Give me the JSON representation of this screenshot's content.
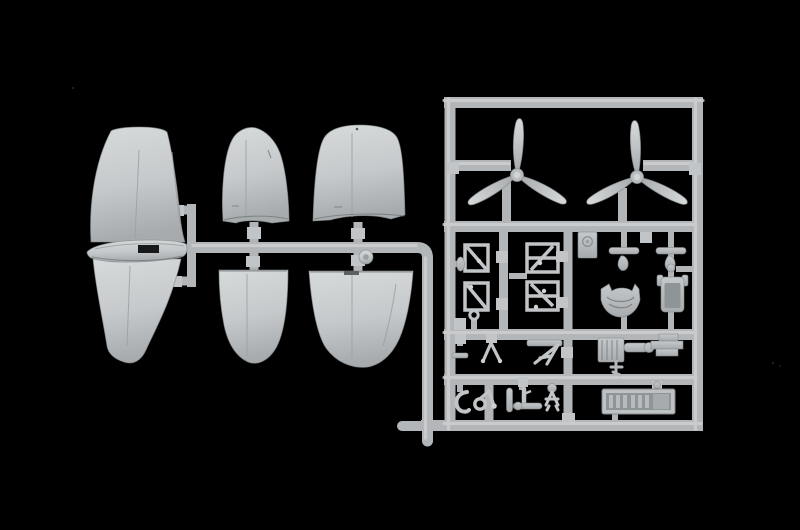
{
  "meta": {
    "description": "Photograph of a light-grey injection-moulded plastic model aircraft sprue on a black background",
    "alt": "Model kit sprue: large wing and tailplane halves on the left joined by a runner, and a rectangular frame on the right holding two three-blade propellers, strut frames, instrument panel, seat, bulkhead, engine block, cockpit floor tray and other small parts"
  },
  "colors": {
    "background": "#000000",
    "plastic_light": "#d7dadb",
    "plastic": "#c6c9cb",
    "plastic_dark": "#a7abad",
    "runner": "#b2b6b8",
    "runner_highlight": "#ced1d2",
    "tab": "#c1c5c7",
    "slot": "#17191a",
    "recess": "#8f9496"
  },
  "parts": {
    "wing_center": "one-piece wing with centre fairing",
    "tailplane_upper": "tailplane half upper",
    "tailplane_lower": "tailplane half lower",
    "outer_wing_upper": "outer wing panel upper",
    "outer_wing_lower": "outer wing panel lower",
    "propeller_left": "three-blade propeller",
    "propeller_right": "three-blade propeller",
    "strut_frames": "undercarriage strut frames",
    "instrument_panel": "instrument panel",
    "control_levers": "control levers",
    "bulkhead": "cockpit bulkhead",
    "seat": "pilot seat",
    "engine": "engine block",
    "cockpit_floor": "cockpit floor tray",
    "detail_parts": "small detail parts"
  }
}
